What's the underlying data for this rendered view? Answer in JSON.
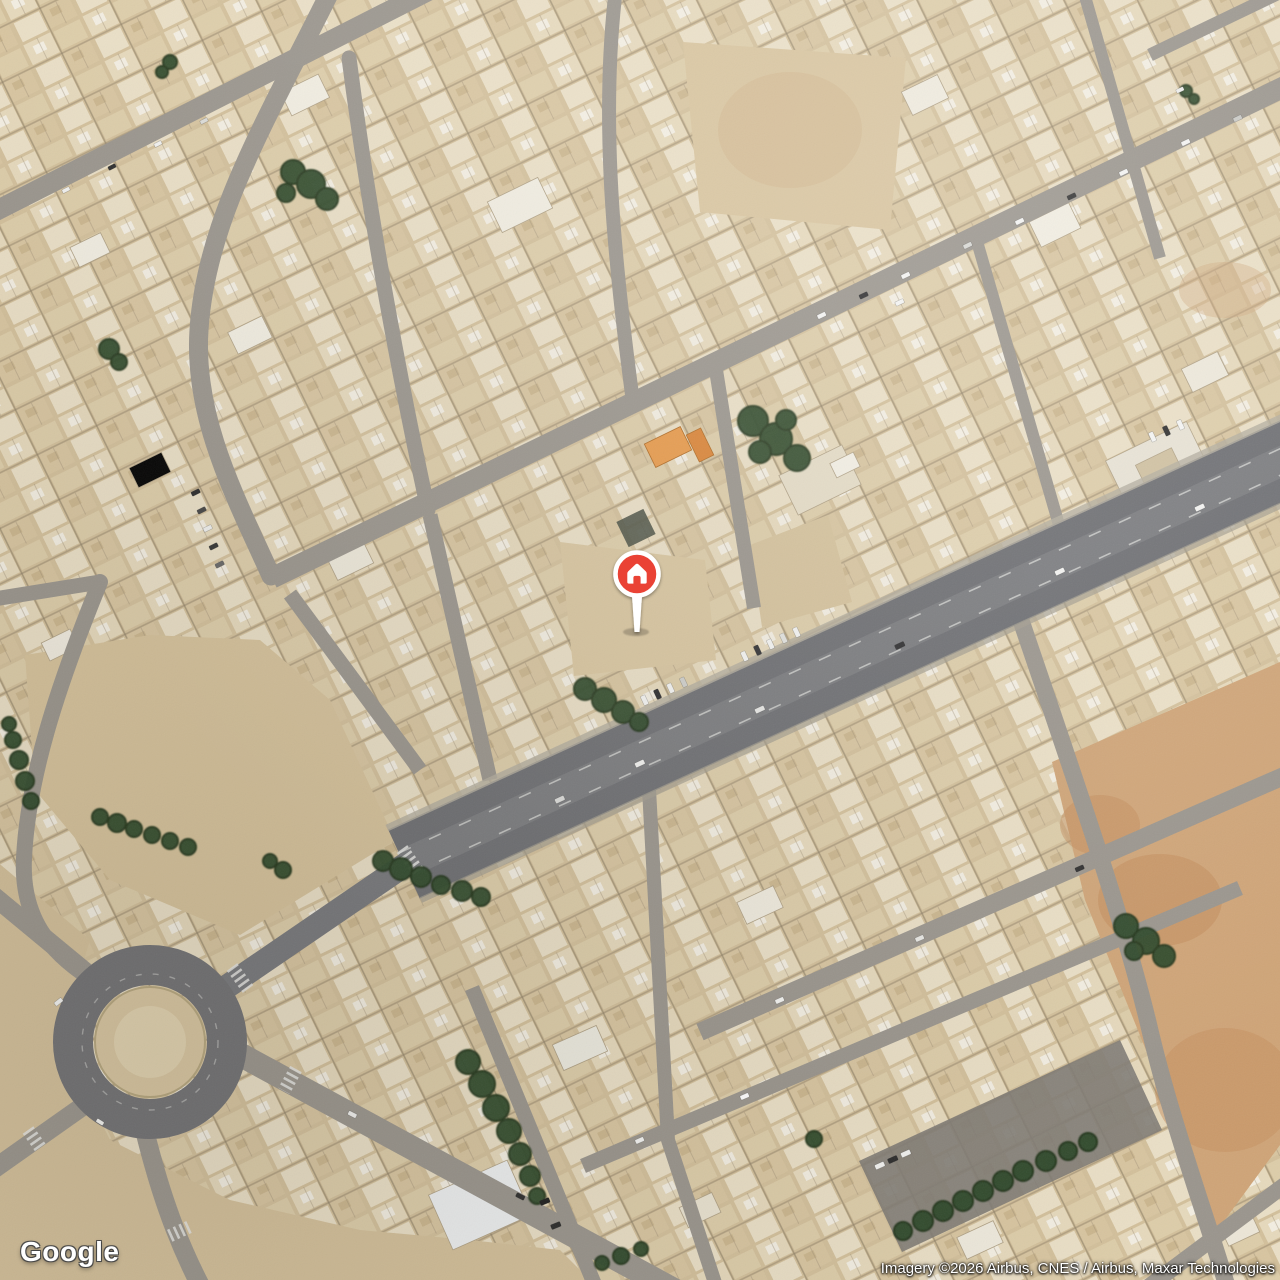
{
  "map": {
    "view_type": "satellite",
    "provider_logo_text": "Google",
    "attribution_text": "Imagery ©2026 Airbus, CNES / Airbus, Maxar Technologies",
    "marker": {
      "icon": "home",
      "color": "#EA4335",
      "position_px": {
        "x": 638,
        "y": 577
      }
    },
    "palette": {
      "sand": "#d3c09b",
      "building_light": "#e8dcc1",
      "roof_white": "#f1ede1",
      "road_gray": "#9a958d",
      "avenue_gray": "#6f6f72",
      "tree_green": "#2f4829",
      "dirt_orange": "#cb9c6e",
      "canopy_orange": "#e89a4a"
    }
  }
}
